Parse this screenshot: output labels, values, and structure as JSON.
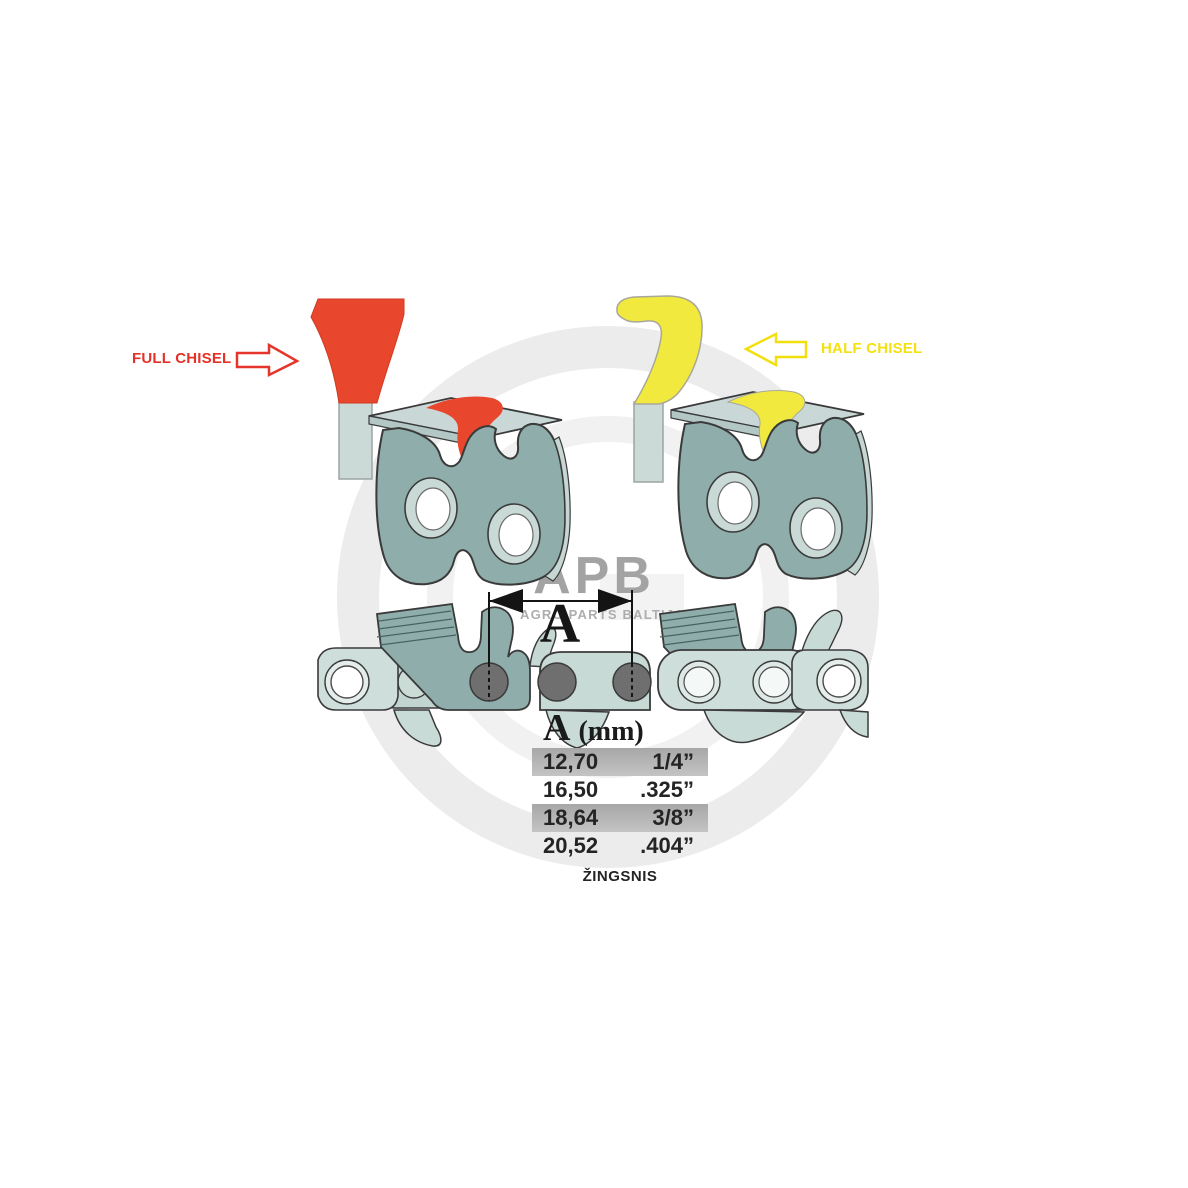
{
  "diagram_title": "Chainsaw chain cutter types and pitch dimension",
  "full_chisel": {
    "label": "FULL CHISEL",
    "color": "#E53227",
    "shape_color": "#E8462D"
  },
  "half_chisel": {
    "label": "HALF CHISEL",
    "color": "#F3E112",
    "shape_color": "#F2E93E"
  },
  "dimension": {
    "letter": "A"
  },
  "pitch_table": {
    "header_letter": "A",
    "header_unit": "(mm)",
    "columns": [
      "mm",
      "inch"
    ],
    "rows": [
      {
        "mm": "12,70",
        "inch": "1/4”",
        "highlighted": true
      },
      {
        "mm": "16,50",
        "inch": ".325”",
        "highlighted": false
      },
      {
        "mm": "18,64",
        "inch": "3/8”",
        "highlighted": true
      },
      {
        "mm": "20,52",
        "inch": ".404”",
        "highlighted": false
      }
    ],
    "row_highlight_color": "#B2B2B2",
    "caption": "ŽINGSNIS"
  },
  "watermark": {
    "initials": "APB",
    "company": "AGRO PARTS BALTIJA",
    "ring_color": "#ECECEC"
  },
  "artwork_colors": {
    "cutter_body_teal": "#8FAEAB",
    "chain_link_light": "#CEDEDA",
    "top_plate_gray": "#C9D8D6",
    "rivet_gray": "#6F6F6F",
    "outline": "#3A3A3A"
  }
}
